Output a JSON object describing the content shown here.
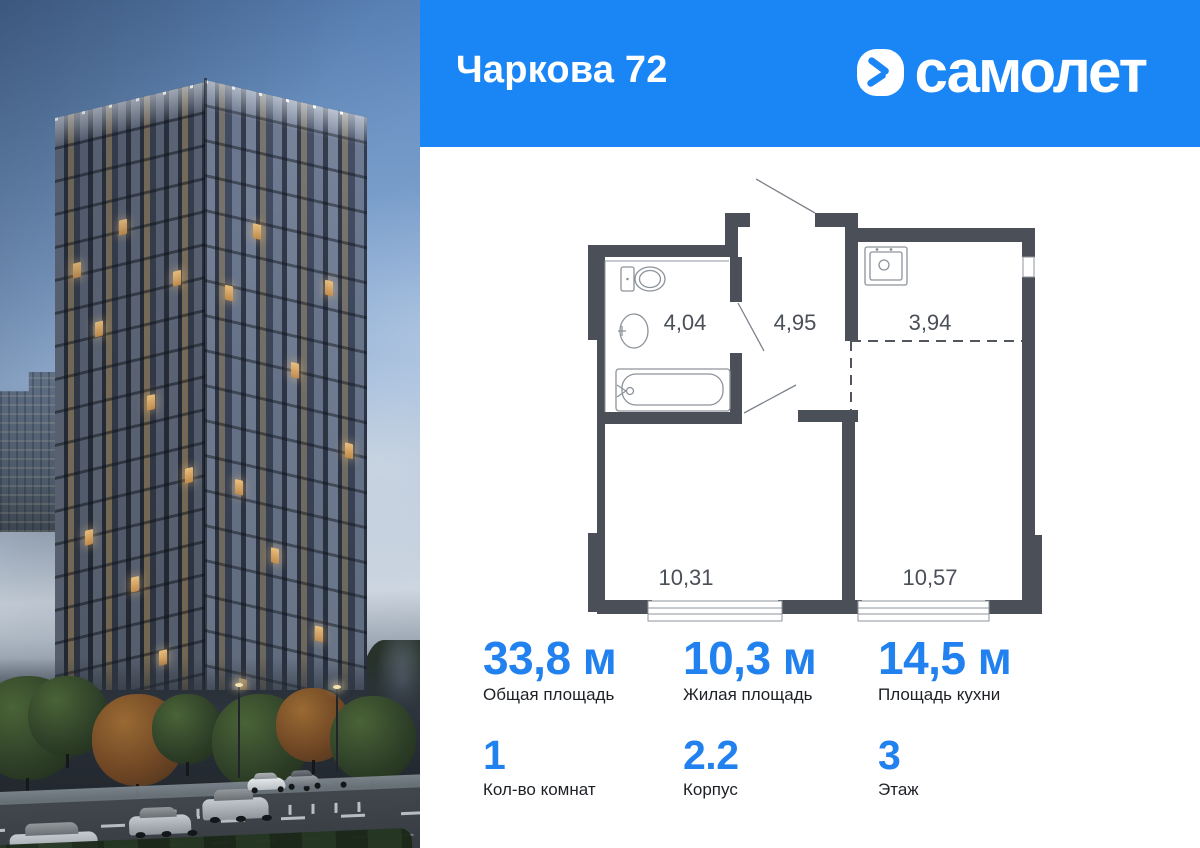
{
  "header": {
    "title": "Чаркова 72",
    "brand": "самолет"
  },
  "colors": {
    "banner_blue": "#1a86f6",
    "stat_value_blue": "#2181ef",
    "plan_wall": "#4a4f58"
  },
  "floorplan": {
    "rooms": [
      {
        "name": "bathroom",
        "area": "4,04"
      },
      {
        "name": "hallway",
        "area": "4,95"
      },
      {
        "name": "kitchen",
        "area": "3,94"
      },
      {
        "name": "living-room",
        "area": "10,31"
      },
      {
        "name": "bedroom",
        "area": "10,57"
      }
    ]
  },
  "stats": {
    "total_area": {
      "value": "33,8 м",
      "label": "Общая площадь"
    },
    "living_area": {
      "value": "10,3 м",
      "label": "Жилая площадь"
    },
    "kitchen_area": {
      "value": "14,5 м",
      "label": "Площадь кухни"
    },
    "rooms_count": {
      "value": "1",
      "label": "Кол-во комнат"
    },
    "building": {
      "value": "2.2",
      "label": "Корпус"
    },
    "floor": {
      "value": "3",
      "label": "Этаж"
    }
  }
}
